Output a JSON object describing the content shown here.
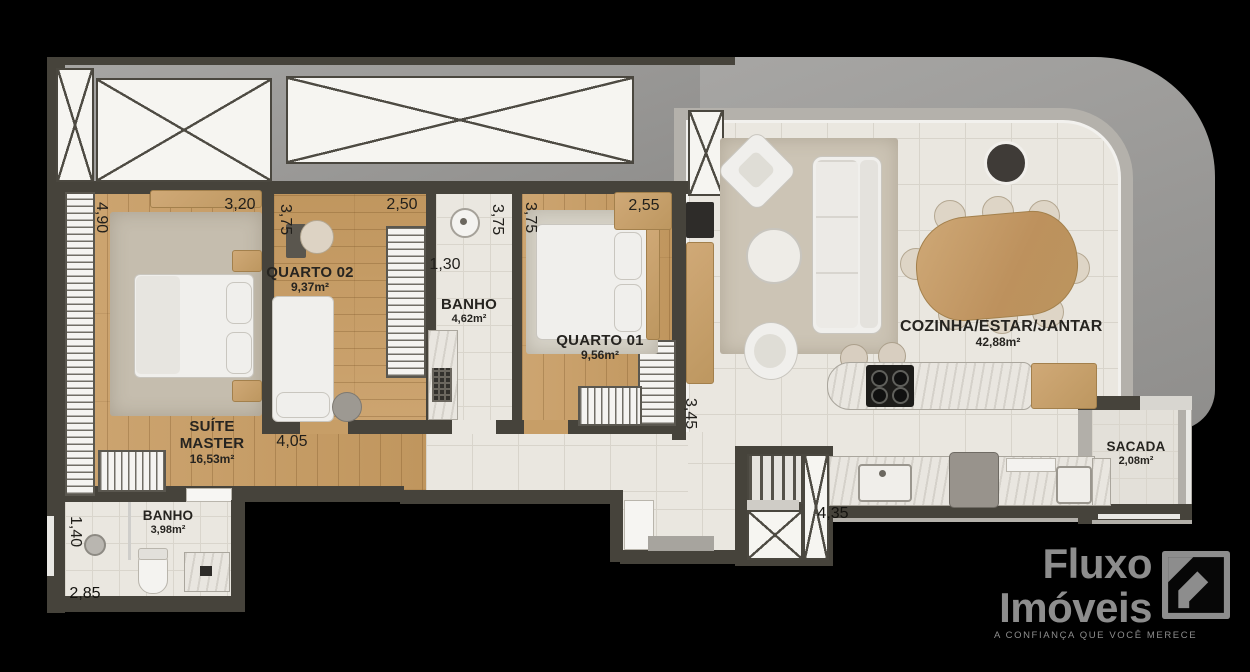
{
  "canvas": {
    "width": 1250,
    "height": 672
  },
  "palette": {
    "background": "#000000",
    "wall": "#46433b",
    "concrete_band": "#9c9b99",
    "wood_floor": "#c79e67",
    "tile_floor": "#eae7e0",
    "marble": "#e9e6e0",
    "rug": "#ccc4b5",
    "furniture_white": "#f0efec",
    "furniture_wood": "#c7a26d",
    "appliance_black": "#1d1c1a",
    "label_text": "#262420",
    "logo_gray": "#8d8d8d"
  },
  "labels": {
    "suite": {
      "name1": "SUÍTE",
      "name2": "MASTER",
      "area": "16,53m²"
    },
    "quarto02": {
      "name": "QUARTO 02",
      "area": "9,37m²"
    },
    "banho_suite": {
      "name": "BANHO",
      "area": "4,62m²"
    },
    "quarto01": {
      "name": "QUARTO 01",
      "area": "9,56m²"
    },
    "cozinha": {
      "name": "COZINHA/ESTAR/JANTAR",
      "area": "42,88m²"
    },
    "banho_social": {
      "name": "BANHO",
      "area": "3,98m²"
    },
    "sacada": {
      "name": "SACADA",
      "area": "2,08m²"
    }
  },
  "dimensions": {
    "suite_left": "4,90",
    "suite_top": "3,20",
    "quarto02_left": "3,75",
    "quarto02_top": "2,50",
    "banho_suite_left": "3,75",
    "quarto01_left": "3,75",
    "quarto01_top": "2,55",
    "banho_suite_width": "1,30",
    "hall": "4,05",
    "living_left": "3,45",
    "kitchen": "4,35",
    "banho_social_left": "1,40",
    "banho_social_bottom": "2,85"
  },
  "logo": {
    "brand_top": "Fluxo",
    "brand_bottom": "Imóveis",
    "tagline": "A CONFIANÇA QUE VOCÊ MERECE"
  }
}
